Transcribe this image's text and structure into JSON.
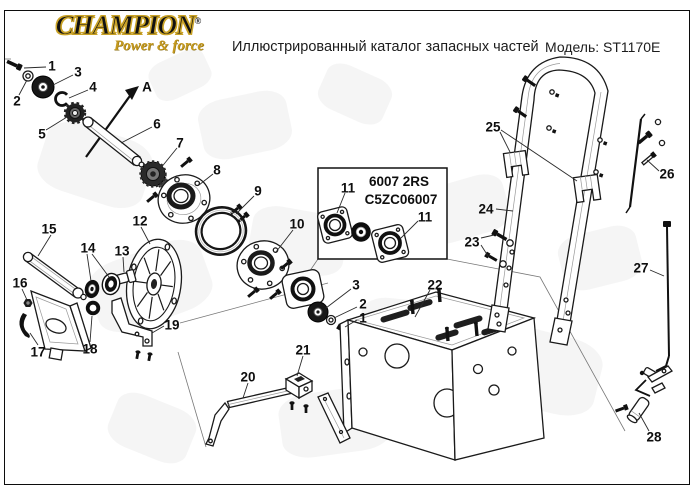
{
  "header": {
    "brand_name": "CHAMPION",
    "brand_reg": "®",
    "brand_tagline": "Power & force",
    "title": "Иллюстрированный каталог запасных частей",
    "model_label": "Модель: ST1170E"
  },
  "inset_box": {
    "line1": "6007 2RS",
    "line2": "C5ZC06007"
  },
  "colors": {
    "brand_gold": "#c59a1f",
    "ink": "#111111",
    "paper": "#ffffff",
    "watermark": "#ededed"
  },
  "callouts": [
    {
      "label": "1",
      "x": 52,
      "y": 66
    },
    {
      "label": "2",
      "x": 17,
      "y": 101
    },
    {
      "label": "3",
      "x": 78,
      "y": 72
    },
    {
      "label": "4",
      "x": 93,
      "y": 87
    },
    {
      "label": "5",
      "x": 42,
      "y": 134
    },
    {
      "label": "6",
      "x": 157,
      "y": 124
    },
    {
      "label": "7",
      "x": 180,
      "y": 143
    },
    {
      "label": "8",
      "x": 217,
      "y": 170
    },
    {
      "label": "9",
      "x": 258,
      "y": 191
    },
    {
      "label": "10",
      "x": 297,
      "y": 224
    },
    {
      "label": "11",
      "x": 348,
      "y": 188
    },
    {
      "label": "11",
      "x": 425,
      "y": 217
    },
    {
      "label": "12",
      "x": 140,
      "y": 221
    },
    {
      "label": "13",
      "x": 122,
      "y": 251
    },
    {
      "label": "14",
      "x": 88,
      "y": 248
    },
    {
      "label": "15",
      "x": 49,
      "y": 229
    },
    {
      "label": "16",
      "x": 20,
      "y": 283
    },
    {
      "label": "17",
      "x": 38,
      "y": 352
    },
    {
      "label": "18",
      "x": 90,
      "y": 349
    },
    {
      "label": "19",
      "x": 172,
      "y": 325
    },
    {
      "label": "20",
      "x": 248,
      "y": 377
    },
    {
      "label": "21",
      "x": 303,
      "y": 350
    },
    {
      "label": "22",
      "x": 435,
      "y": 285
    },
    {
      "label": "23",
      "x": 472,
      "y": 242
    },
    {
      "label": "24",
      "x": 486,
      "y": 209
    },
    {
      "label": "25",
      "x": 493,
      "y": 127
    },
    {
      "label": "26",
      "x": 667,
      "y": 174
    },
    {
      "label": "27",
      "x": 641,
      "y": 268
    },
    {
      "label": "28",
      "x": 654,
      "y": 437
    },
    {
      "label": "3",
      "x": 356,
      "y": 285
    },
    {
      "label": "2",
      "x": 363,
      "y": 304
    },
    {
      "label": "1",
      "x": 363,
      "y": 318
    },
    {
      "label": "A",
      "x": 147,
      "y": 87
    }
  ]
}
